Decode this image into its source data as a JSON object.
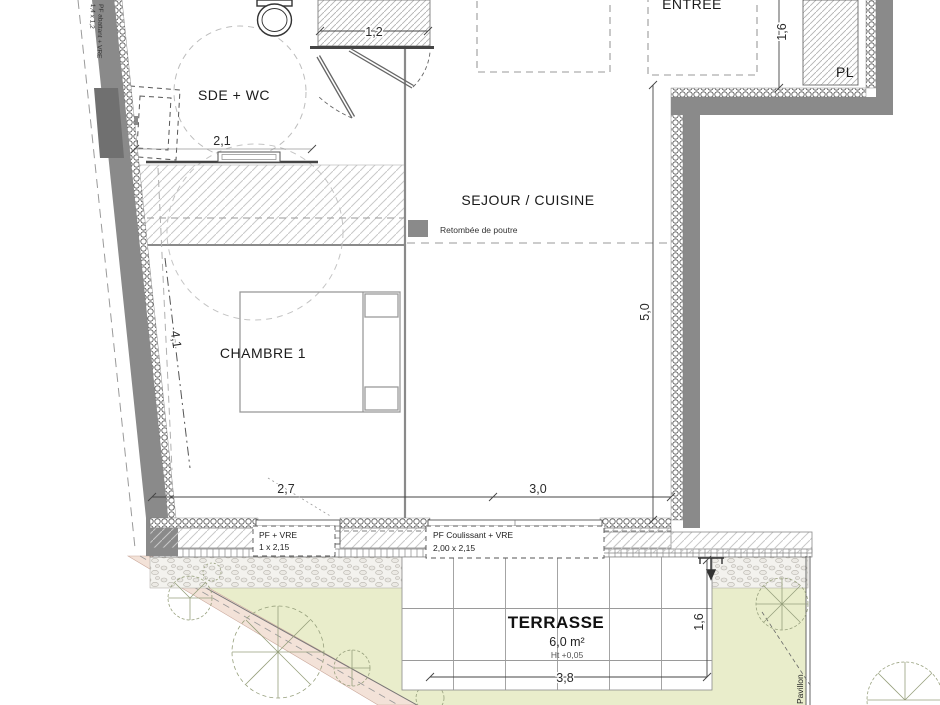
{
  "rooms": {
    "sde_wc": "SDE + WC",
    "sejour": "SEJOUR / CUISINE",
    "chambre": "CHAMBRE 1",
    "entree": "ENTREE",
    "placard": "PL",
    "terrasse": "TERRASSE",
    "terrasse_area": "6,0 m²",
    "terrasse_height": "Ht +0,05"
  },
  "legend": {
    "label": "Retombée de poutre",
    "swatch_color": "#8a8a8a"
  },
  "dimensions": {
    "door_width": "1,2",
    "sde_width": "2,1",
    "chambre_diag": "4,1",
    "chambre_width": "2,7",
    "sejour_width": "3,0",
    "sejour_depth": "5,0",
    "entree_depth": "1,6",
    "terrasse_depth": "1,6",
    "terrasse_width": "3,8"
  },
  "windows": {
    "chambre": {
      "line1": "PF + VRE",
      "line2": "1 x 2,15"
    },
    "sejour": {
      "line1": "PF Coulissant + VRE",
      "line2": "2,00 x 2,15"
    },
    "sde": {
      "line1": "PF abattant + VRE",
      "line2": "1,4 x 1,2"
    }
  },
  "site": {
    "neighbor": "Pavillon"
  },
  "colors": {
    "wall": "#8a8a8a",
    "window_fill": "#707070",
    "lawn": "#e9edcb",
    "path": "#f3e2d8"
  }
}
